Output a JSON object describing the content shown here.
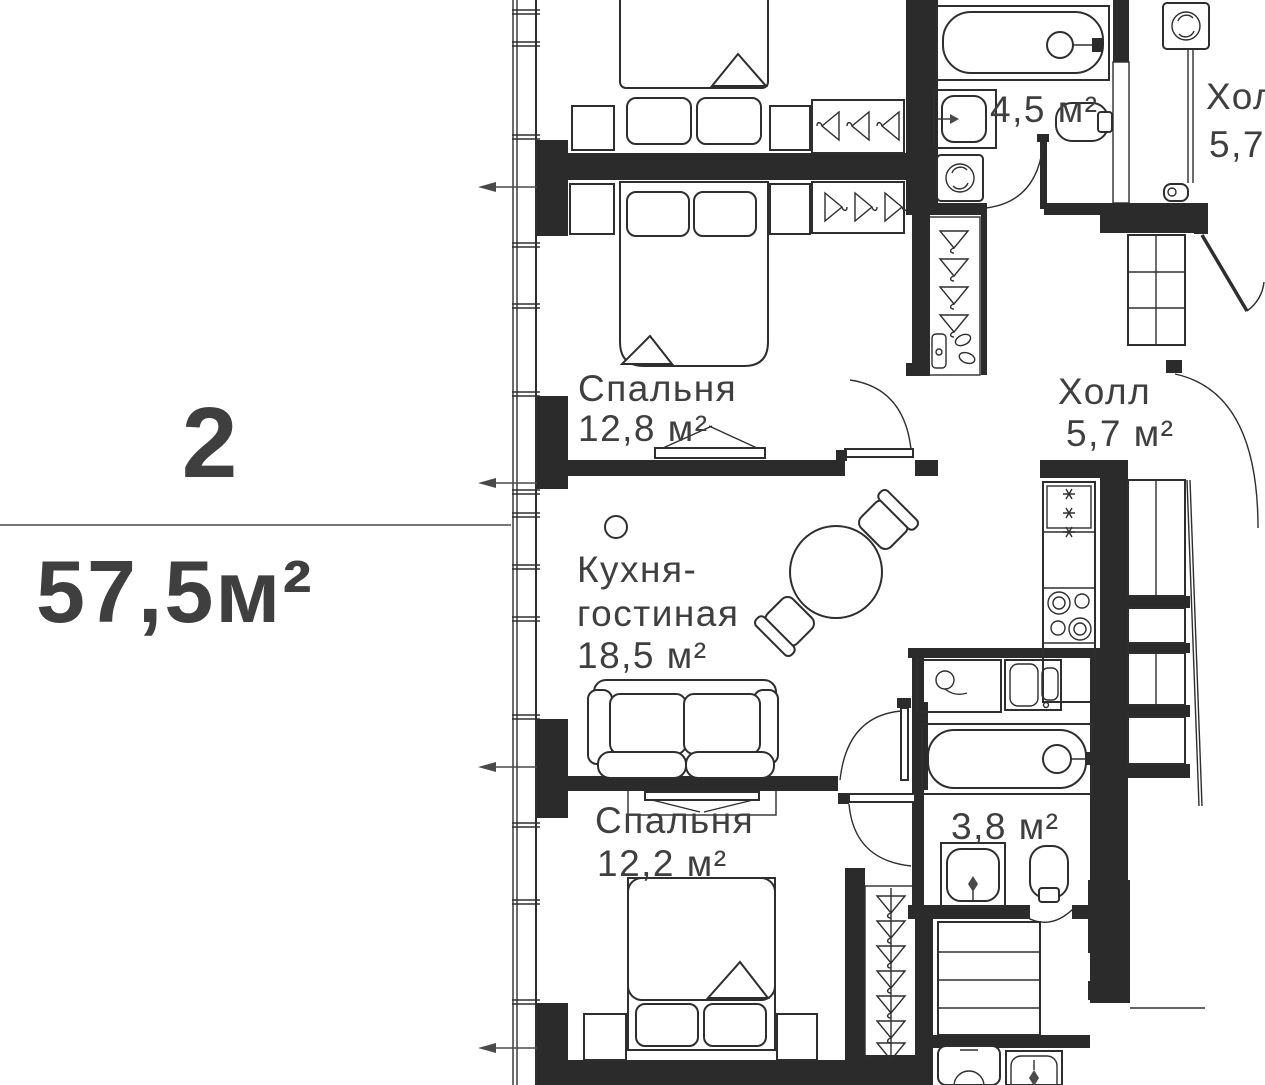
{
  "unit": {
    "rooms_count": "2",
    "total_area": "57,5м²"
  },
  "rooms": {
    "bedroom_1": {
      "name": "Спальня",
      "area": "12,8 м²"
    },
    "kitchen_living": {
      "name_line1": "Кухня-",
      "name_line2": "гостиная",
      "area": "18,5 м²"
    },
    "bedroom_2": {
      "name": "Спальня",
      "area": "12,2 м²"
    },
    "hall": {
      "name": "Холл",
      "area": "5,7 м²"
    },
    "bathroom_1": {
      "area": "4,5 м²"
    },
    "bathroom_2": {
      "area": "3,8 м²"
    }
  },
  "neighbor": {
    "hall_name_cut": "Хол",
    "hall_area_cut": "5,7"
  },
  "icons": {
    "hanger-icon": "clothes-hanger triangle outline",
    "snowflake-icon": "fridge asterisk",
    "washing-machine-icon": "square with drum circle",
    "toilet-icon": "rounded bowl with tank",
    "bathtub-icon": "rounded tub with faucet circle",
    "door-arc-icon": "quarter-circle door swing",
    "dimension-arrow-icon": "left pointing arrow",
    "window-icon": "double-line facade band"
  },
  "colors": {
    "wall": "#2b2b2b",
    "line": "#2e2e2e",
    "text": "#3f3f3f",
    "dim": "#4a4a4a",
    "bg": "#ffffff"
  }
}
